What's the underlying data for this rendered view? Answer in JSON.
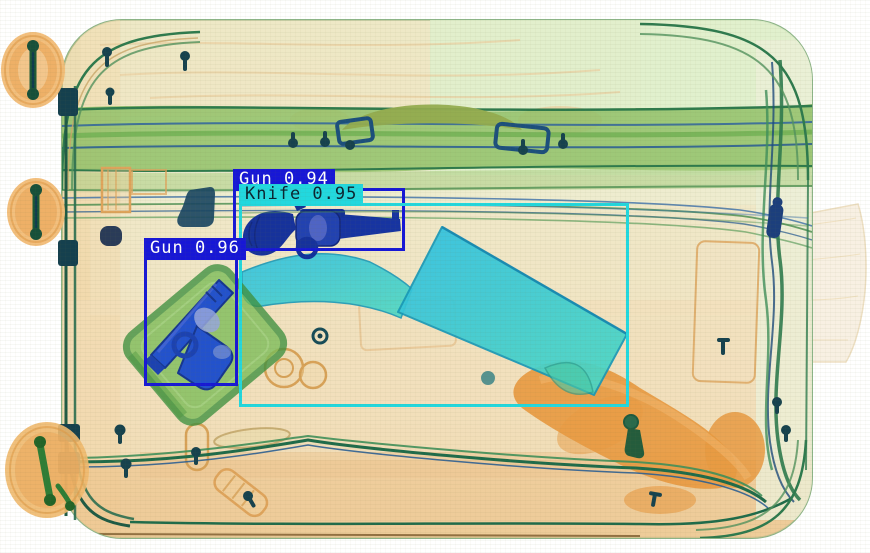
{
  "scene": {
    "type": "xray-baggage-scan",
    "description": "Airport security X-ray scan of a suitcase containing two guns and a knife, with object-detection bounding boxes",
    "background_color": "#ffffff",
    "palette": {
      "case_green": "#e9efd6",
      "strap_green": "#92c168",
      "outline_green": "#2e7a4c",
      "organic_orange": "#eda95e",
      "metal_blue": "#1a3cb0",
      "knife_cyan": "#35c4de"
    }
  },
  "detections": [
    {
      "label": "Gun",
      "confidence": 0.94,
      "display": "Gun 0.94",
      "box_color": "#1717d6",
      "text_color": "#ffffff",
      "box": {
        "x": 233,
        "y": 188,
        "width": 172,
        "height": 63
      }
    },
    {
      "label": "Knife",
      "confidence": 0.95,
      "display": "Knife 0.95",
      "box_color": "#22d8de",
      "text_color": "#0c2430",
      "box": {
        "x": 239,
        "y": 203,
        "width": 390,
        "height": 204
      }
    },
    {
      "label": "Gun",
      "confidence": 0.96,
      "display": "Gun 0.96",
      "box_color": "#1717d6",
      "text_color": "#ffffff",
      "box": {
        "x": 144,
        "y": 257,
        "width": 94,
        "height": 129
      }
    }
  ]
}
